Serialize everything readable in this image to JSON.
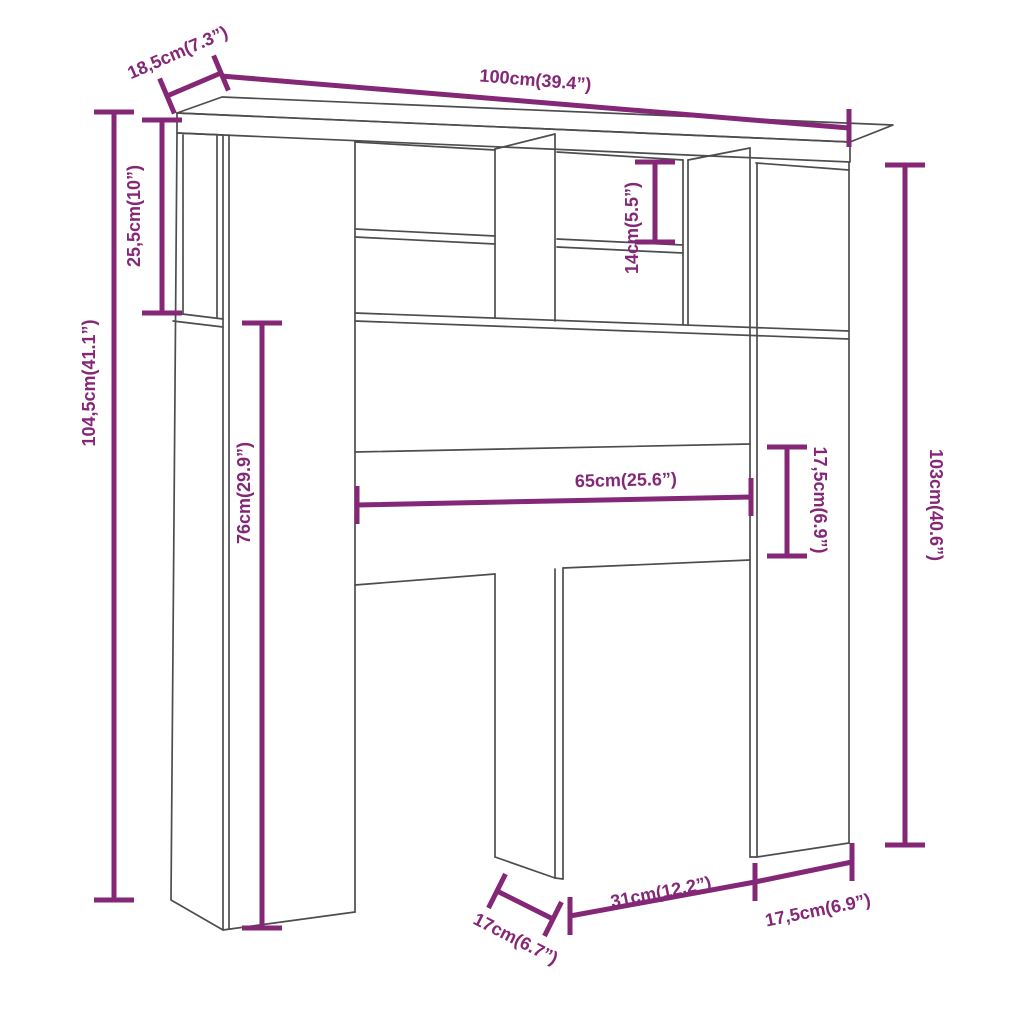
{
  "colors": {
    "dimension": "#842776",
    "outline": "#4d4d4d",
    "background": "#ffffff"
  },
  "dimensions": {
    "depth_top": "18,5cm(7.3”)",
    "width_total": "100cm(39.4”)",
    "height_total": "104,5cm(41.1”)",
    "top_compartment_height": "25,5cm(10”)",
    "column_inner_height": "76cm(29.9”)",
    "cubby_height": "14cm(5.5”)",
    "opening_width": "65cm(25.6”)",
    "rail_height": "17,5cm(6.9”)",
    "side_height": "103cm(40.6”)",
    "leg_depth": "17cm(6.7”)",
    "leg_gap_width": "31cm(12.2”)",
    "right_leg_width": "17,5cm(6.9”)"
  }
}
